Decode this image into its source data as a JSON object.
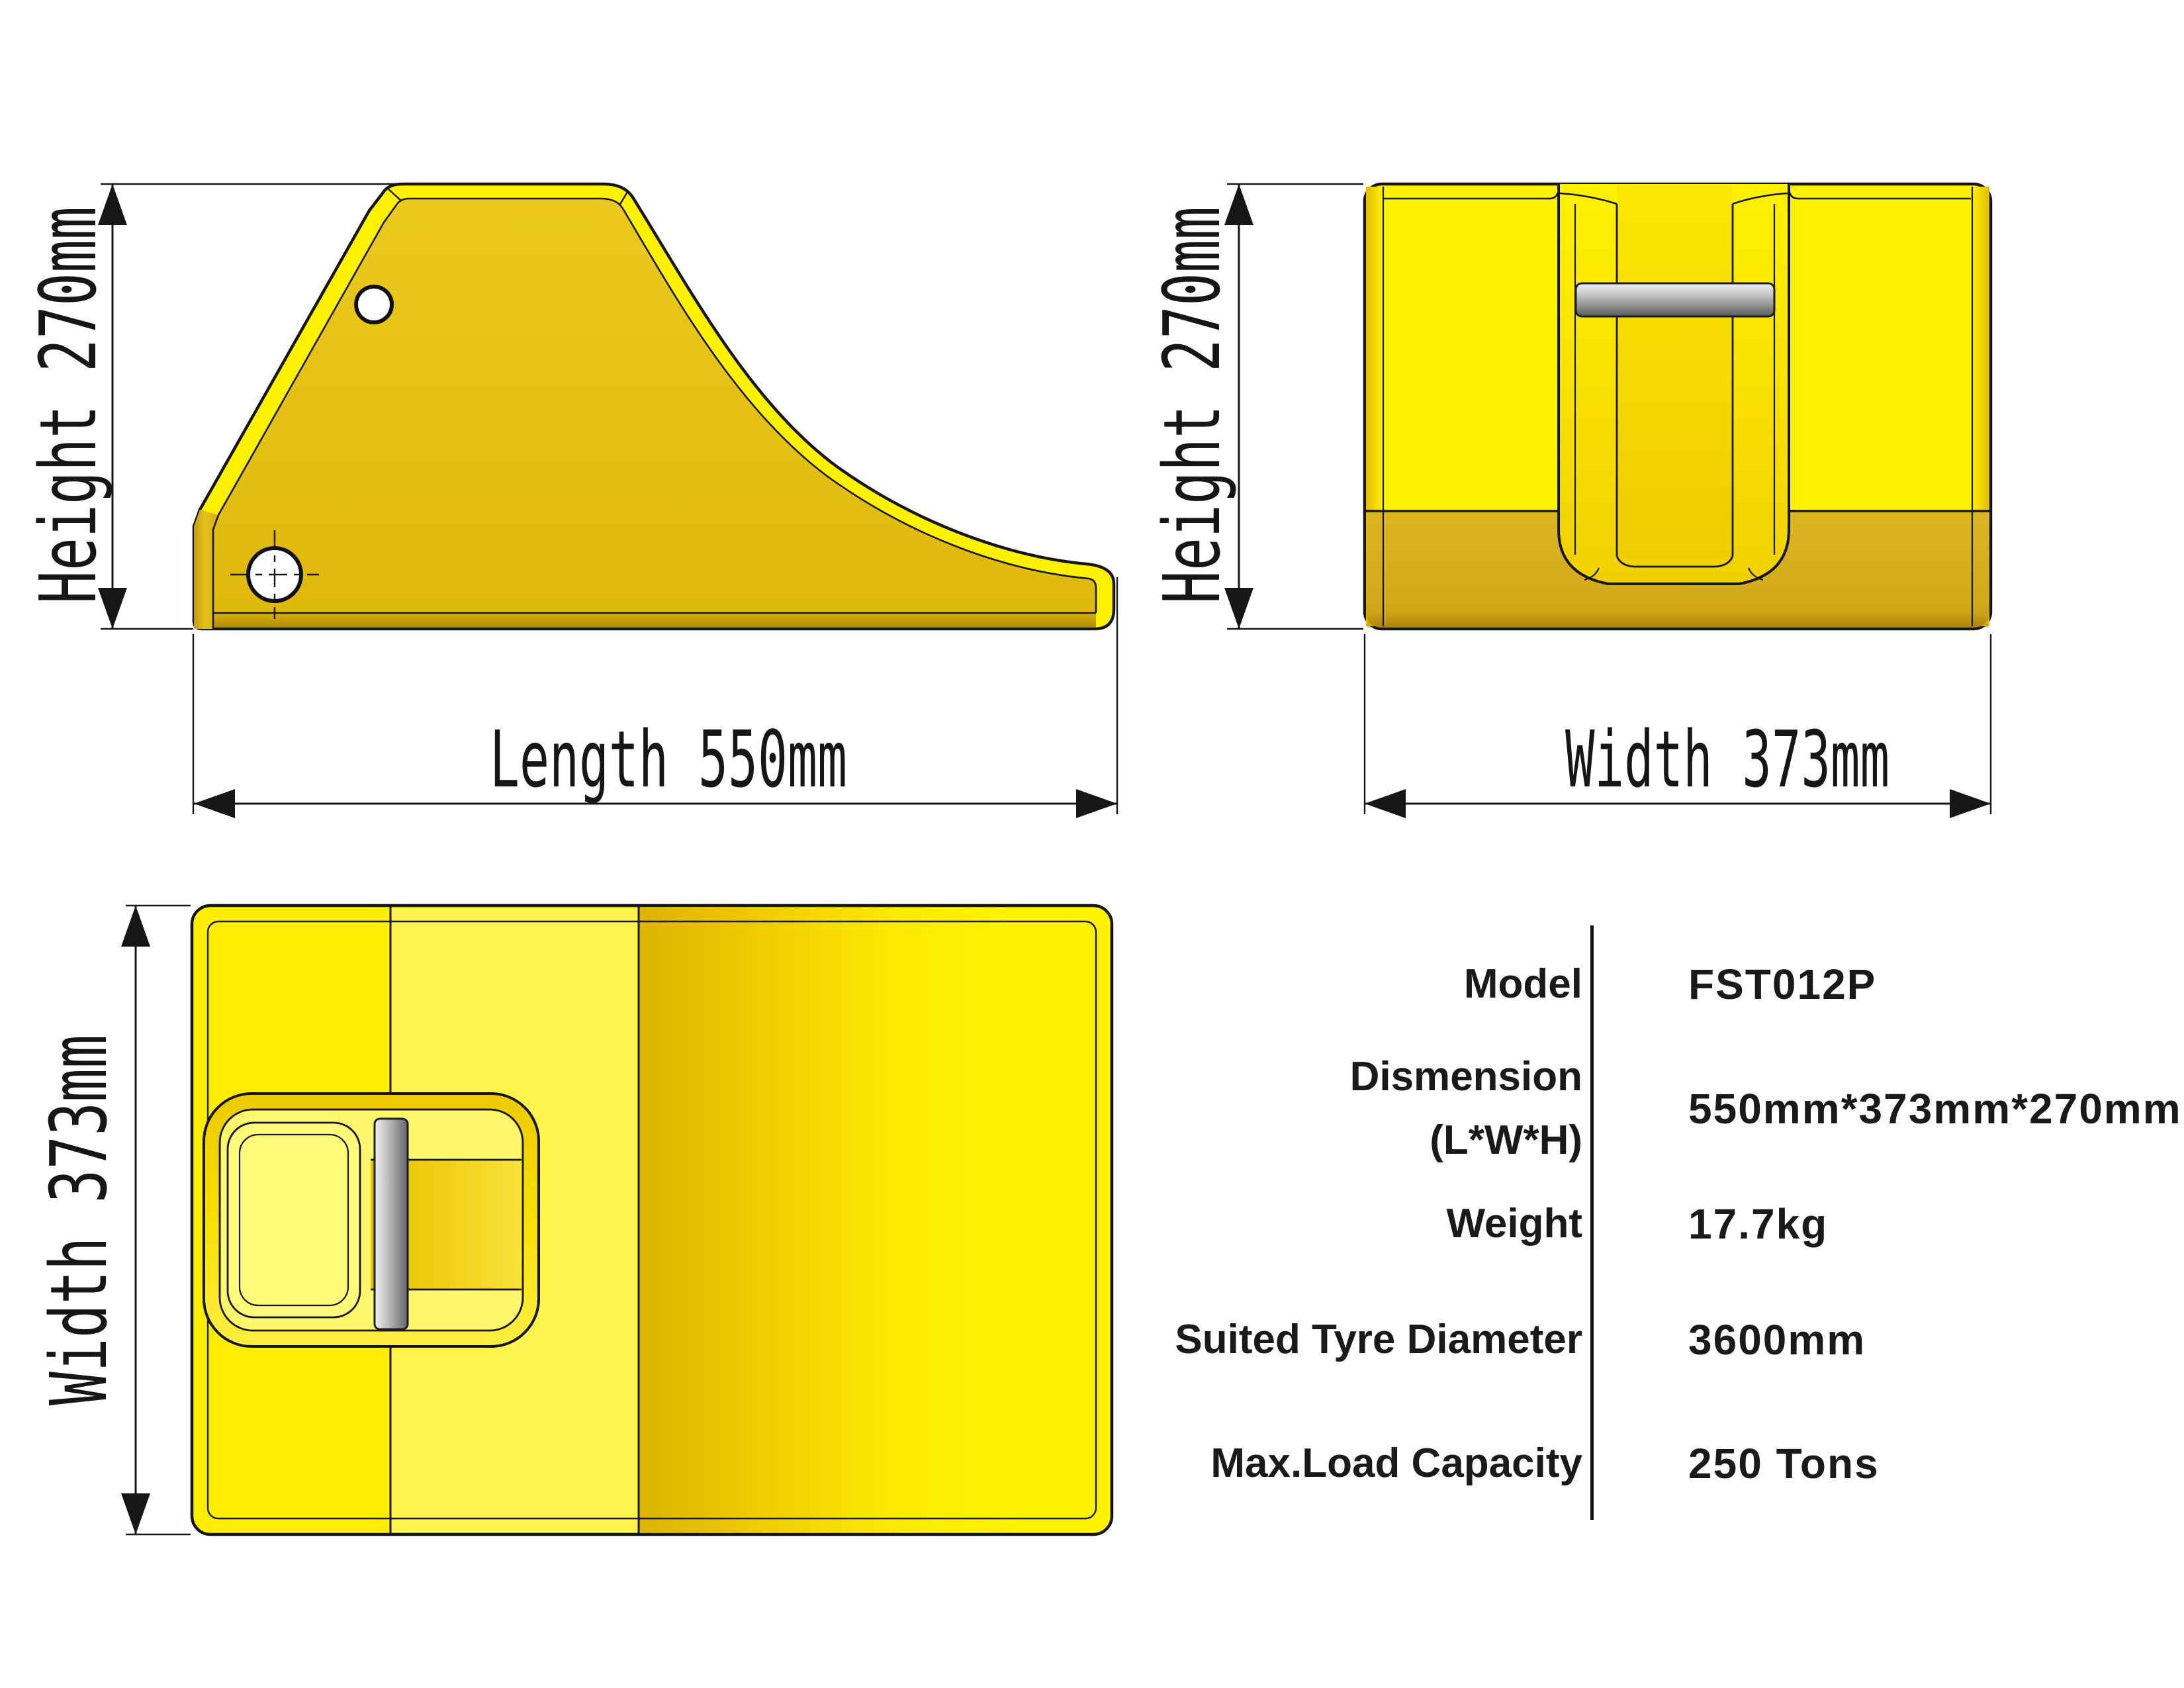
{
  "views": {
    "side": {
      "height_label": "Height 270mm",
      "length_label": "Length 550mm"
    },
    "front": {
      "height_label": "Height 270mm",
      "width_label": "Width 373mm"
    },
    "top": {
      "width_label": "Width 373mm"
    }
  },
  "spec_table": {
    "rows": [
      {
        "label": "Model",
        "value": "FST012P"
      },
      {
        "label": "Dismension",
        "label_line2": "(L*W*H)",
        "value": "550mm*373mm*270mm"
      },
      {
        "label": "Weight",
        "value": "17.7kg"
      },
      {
        "label": "Suited Tyre Diameter",
        "value": "3600mm"
      },
      {
        "label": "Max.Load Capacity",
        "value": "250 Tons"
      }
    ]
  },
  "colors": {
    "chock_bright_yellow": "#FFF100",
    "chock_face_gold": "#E4BE12",
    "front_band_gold": "#D5AC1C",
    "handle_steel_gray": "#8C8C8C",
    "line_black": "#161616",
    "background": "#FFFFFF"
  }
}
